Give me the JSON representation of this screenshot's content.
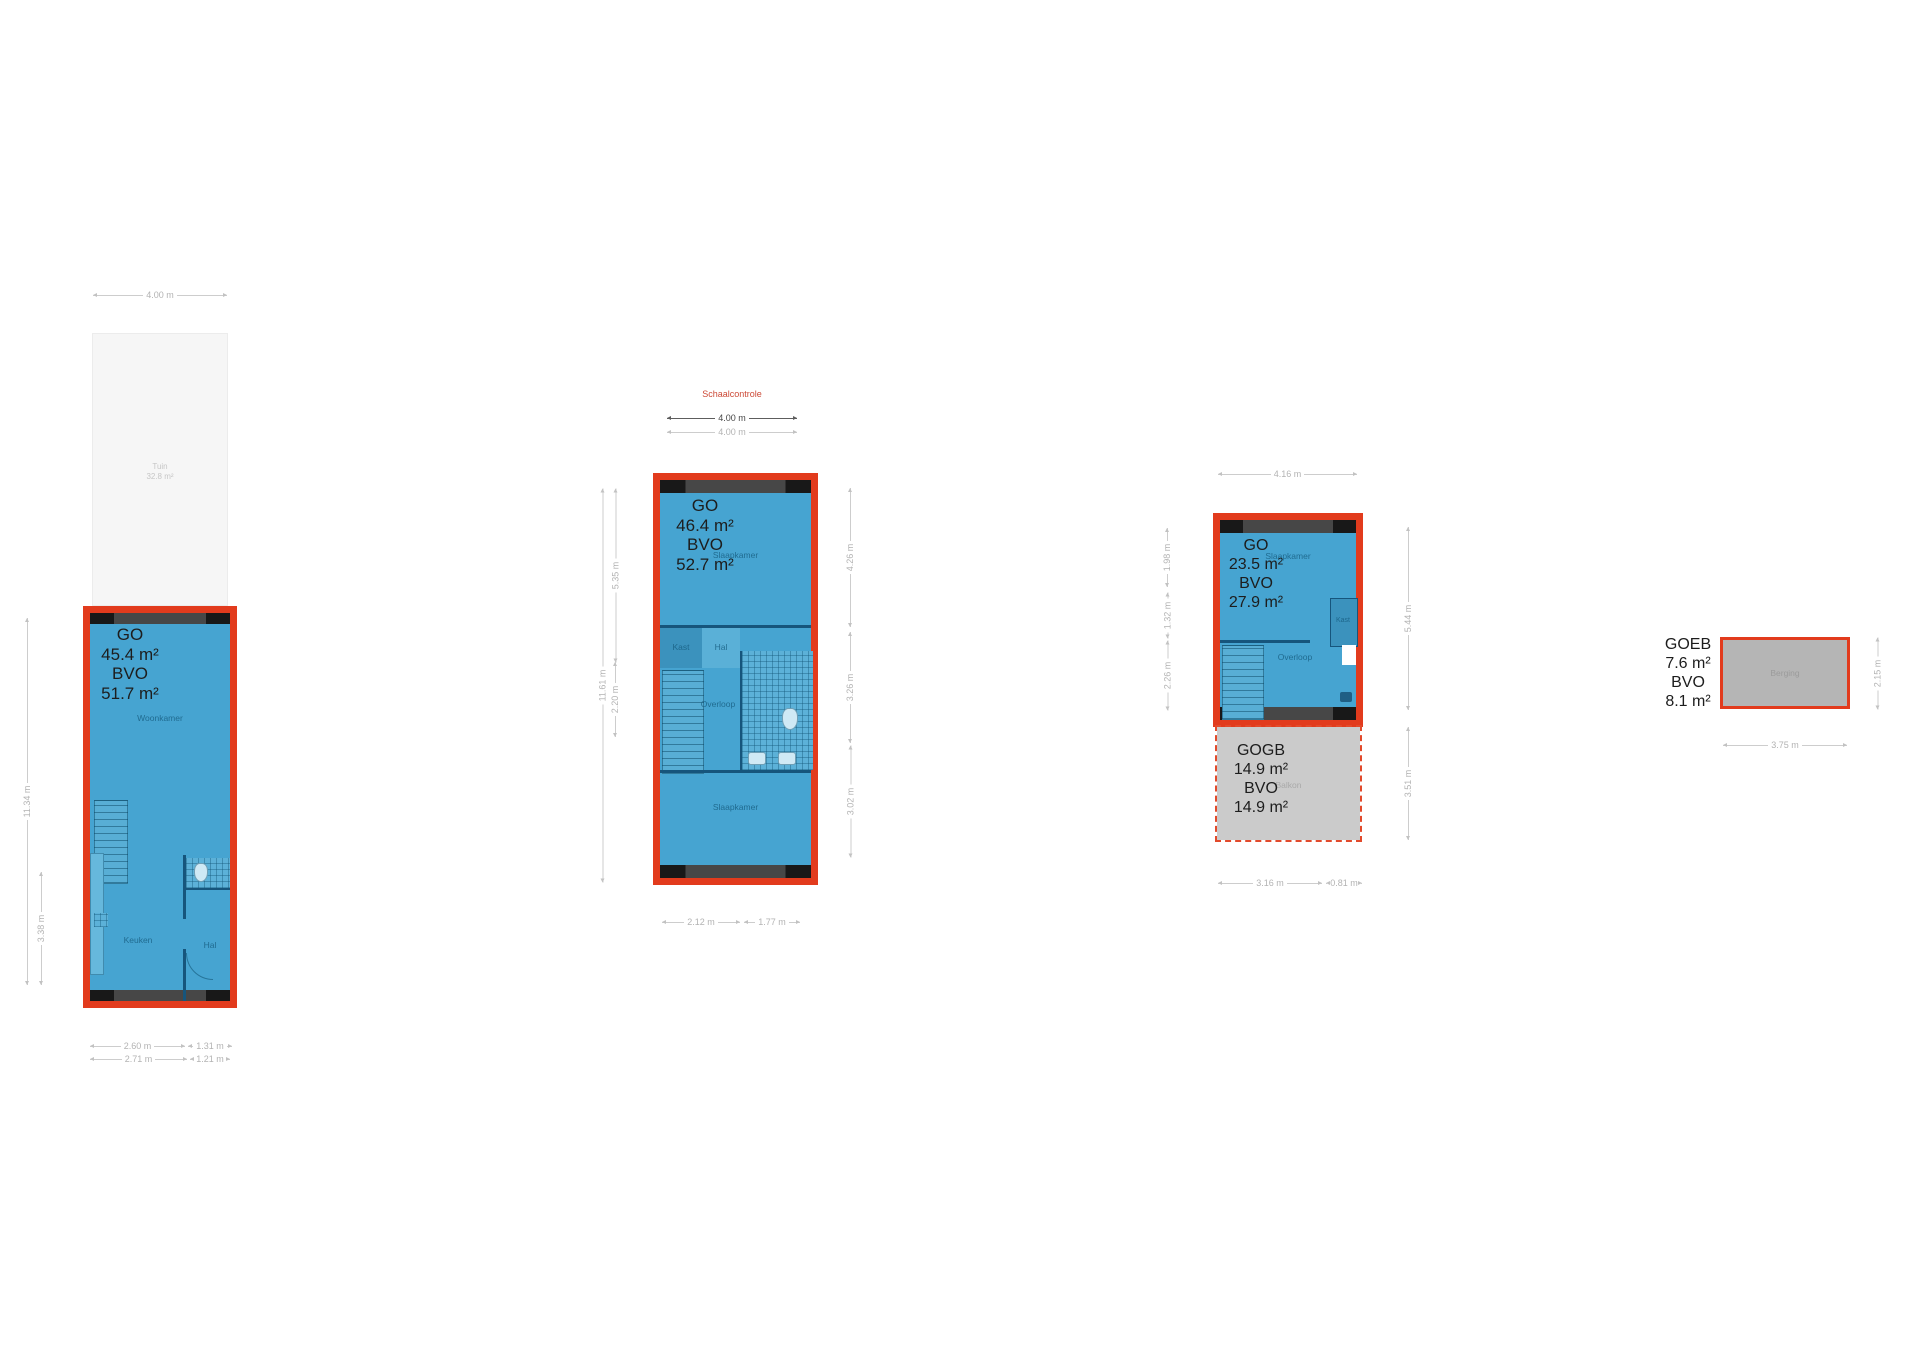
{
  "scale_check": {
    "title": "Schaalcontrole",
    "dim_primary": "4.00 m",
    "dim_secondary": "4.00 m"
  },
  "plans": {
    "ground": {
      "garden": {
        "name": "Tuin",
        "area": "32.8 m²"
      },
      "area_lines": [
        "GO",
        "45.4 m²",
        "BVO",
        "51.7 m²"
      ],
      "rooms": {
        "woonkamer": "Woonkamer",
        "keuken": "Keuken",
        "hal": "Hal"
      },
      "dims": {
        "top": "4.00 m",
        "left_total": "11.34 m",
        "left_lower": "3.38 m",
        "bottom1_left": "2.60 m",
        "bottom1_right": "1.31 m",
        "bottom2_left": "2.71 m",
        "bottom2_right": "1.21 m"
      }
    },
    "first": {
      "area_lines": [
        "GO",
        "46.4 m²",
        "BVO",
        "52.7 m²"
      ],
      "rooms": {
        "slaapkamer_front": "Slaapkamer",
        "kast": "Kast",
        "hal": "Hal",
        "overloop": "Overloop",
        "slaapkamer_back": "Slaapkamer"
      },
      "dims": {
        "left_total": "11.61 m",
        "left_upper": "5.35 m",
        "left_lower": "2.20 m",
        "right_upper": "4.26 m",
        "right_middle": "3.26 m",
        "right_lower": "3.02 m",
        "bottom_left": "2.12 m",
        "bottom_right": "1.77 m"
      }
    },
    "second": {
      "area_lines": [
        "GO",
        "23.5 m²",
        "BVO",
        "27.9 m²"
      ],
      "rooms": {
        "slaapkamer": "Slaapkamer",
        "kast": "Kast",
        "overloop": "Overloop"
      },
      "balcony": {
        "area_lines": [
          "GOGB",
          "14.9 m²",
          "BVO",
          "14.9 m²"
        ],
        "room": "Balkon"
      },
      "dims": {
        "top": "4.16 m",
        "left_upper": "1.98 m",
        "left_middle": "1.32 m",
        "left_lower": "2.26 m",
        "right_upper": "5.44 m",
        "right_lower": "3.51 m",
        "bottom_left": "3.16 m",
        "bottom_right": "0.81 m"
      }
    },
    "storage": {
      "area_lines": [
        "GOEB",
        "7.6 m²",
        "BVO",
        "8.1 m²"
      ],
      "room": "Berging",
      "dims": {
        "bottom": "3.75 m",
        "right": "2.15 m"
      }
    }
  },
  "colors": {
    "accent_red": "#e23b1d",
    "plan_blue": "#46a4d1",
    "balcony_gray": "#cbcbcb",
    "storage_gray": "#b5b5b5",
    "scale_check_red": "#cc4936"
  }
}
